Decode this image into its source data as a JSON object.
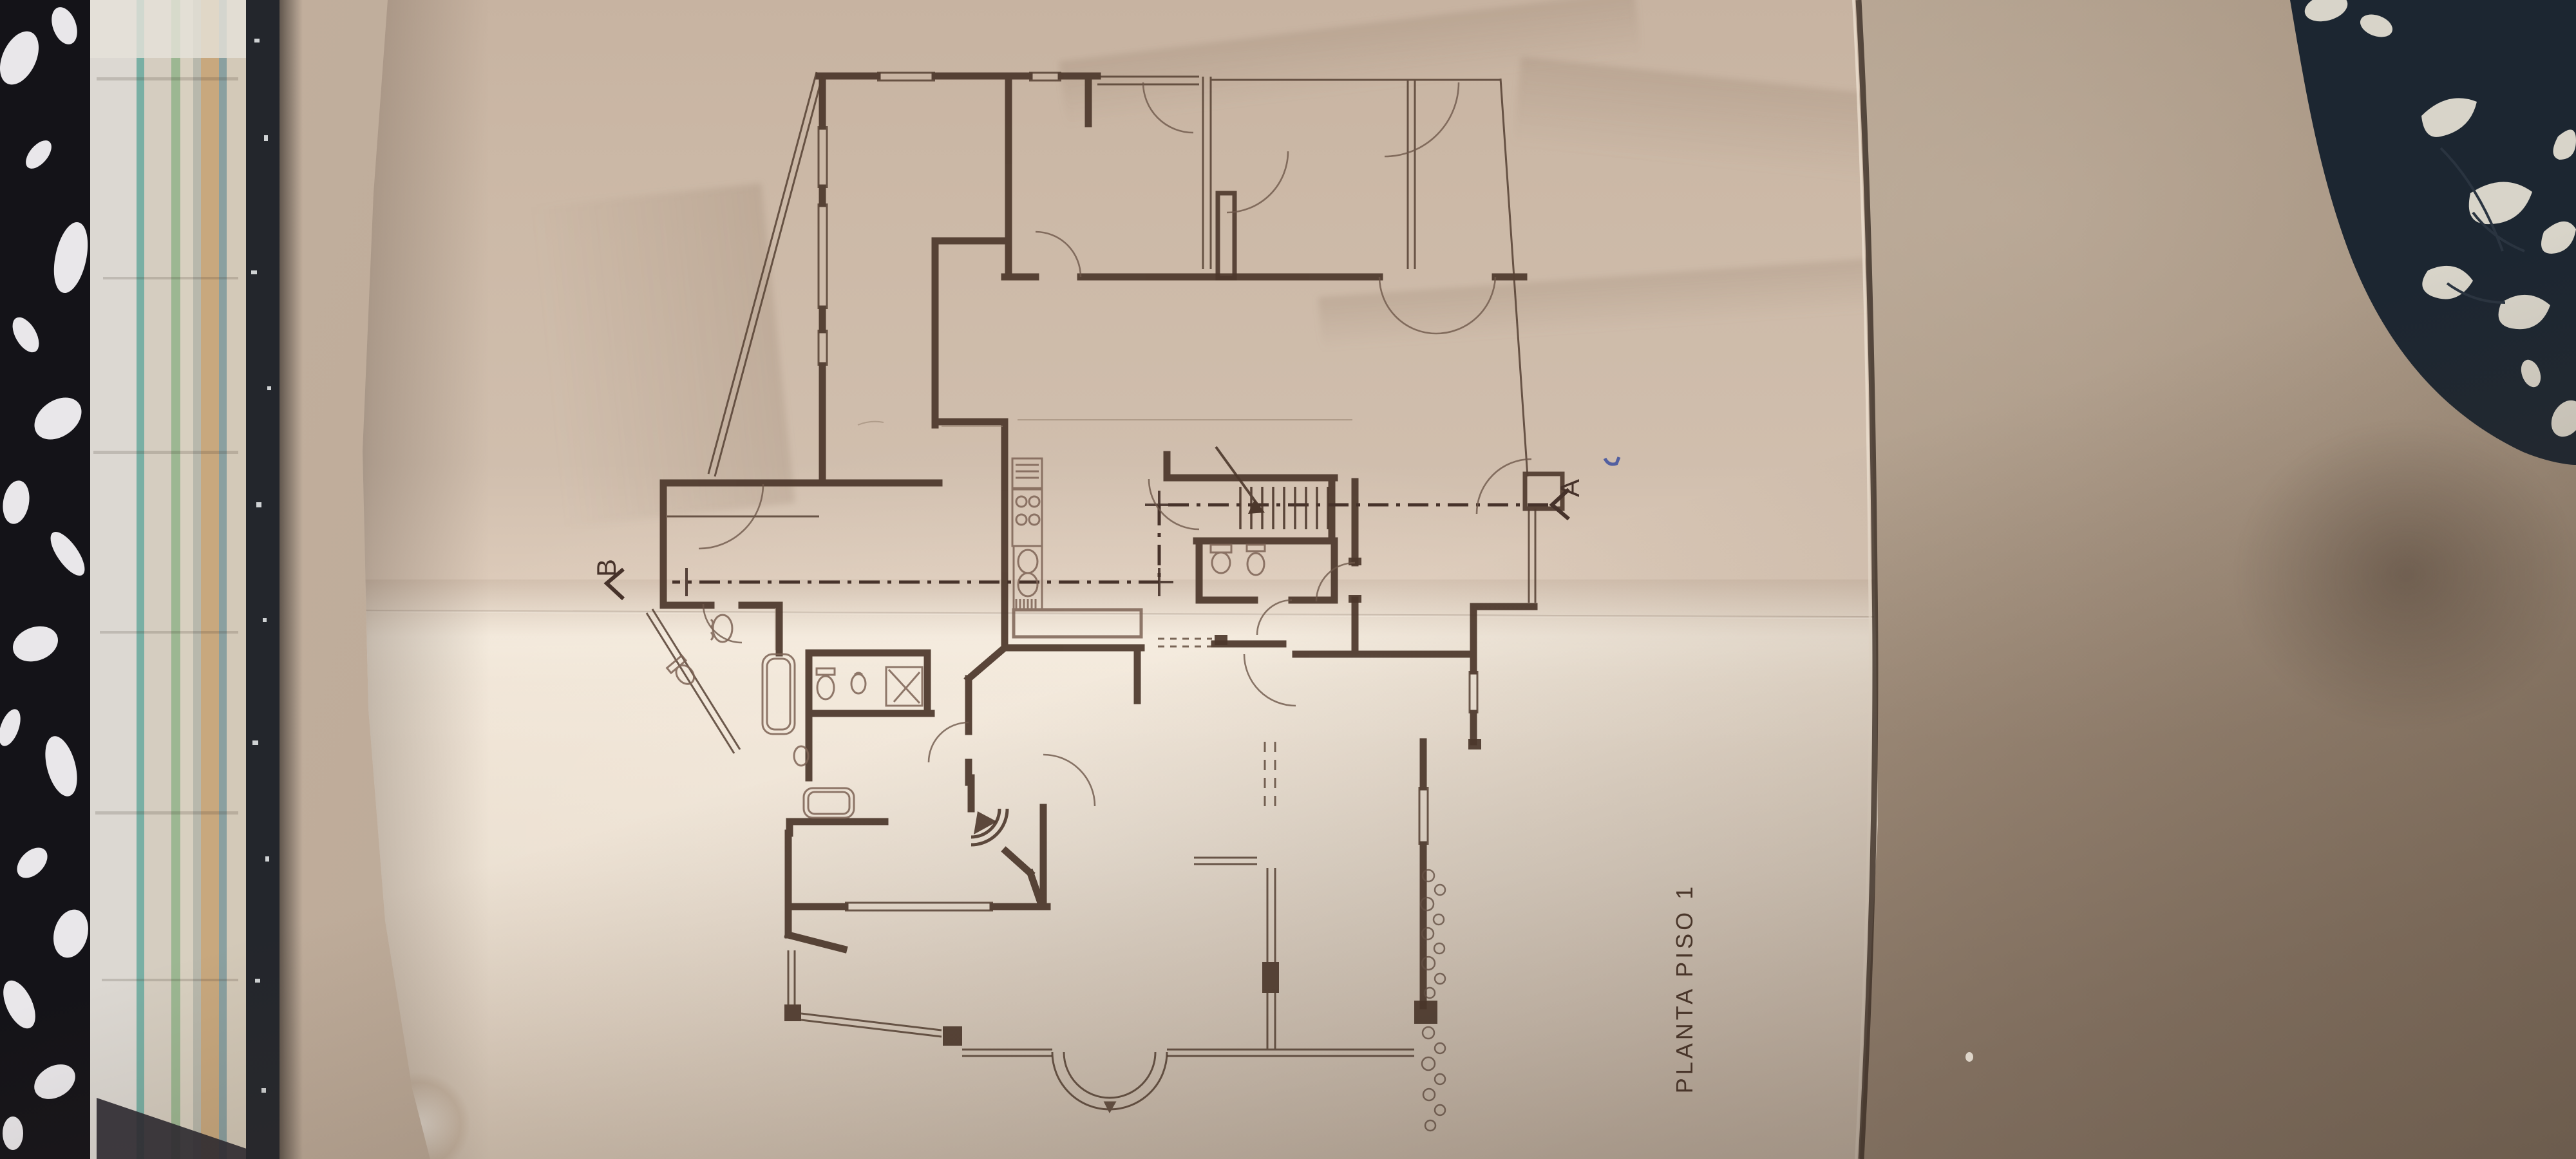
{
  "photo": {
    "plan": {
      "title": "PLANTA PISO 1",
      "section_marker_a": "A",
      "section_marker_b": "B"
    },
    "colors": {
      "paper": "#e9dccc",
      "paper_shadow": "#c7b3a1",
      "ink": "#4c372b",
      "pencil": "#8a7260",
      "wall": "#b7a492",
      "wall_dark": "#8f7b6c",
      "book_cover": "#17161a",
      "book_marble": "#e9e7ea",
      "book_pages": "#cec6b9",
      "chair_fabric": "#1c2631",
      "chair_pattern": "#d8d4c9",
      "pen_mark": "#3c4f9e"
    }
  }
}
